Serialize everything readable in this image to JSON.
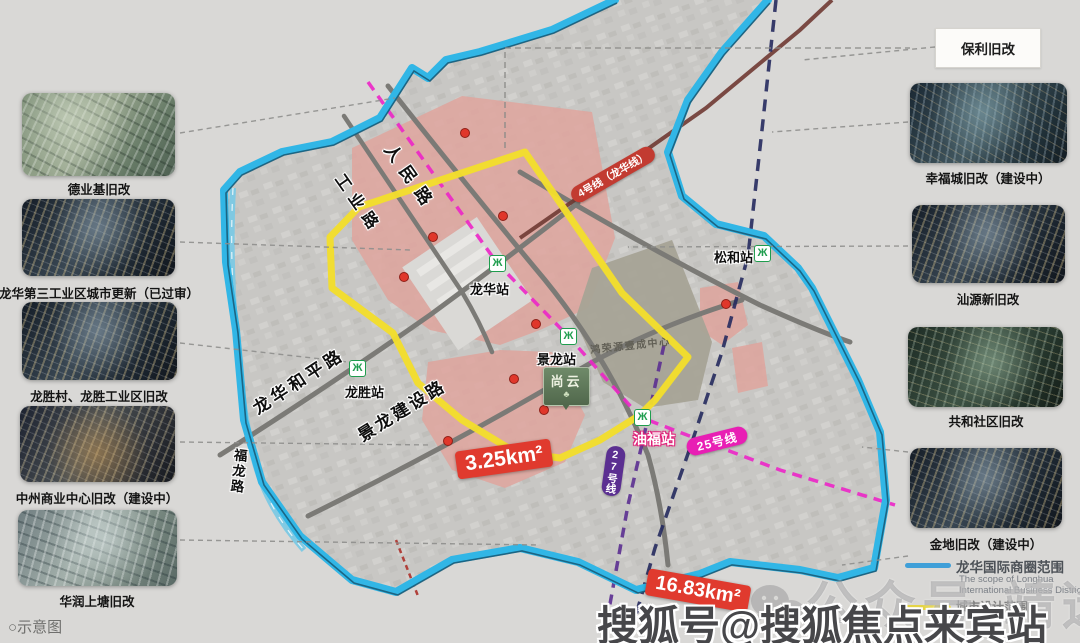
{
  "left_panel": {
    "items": [
      {
        "label": "德业基旧改"
      },
      {
        "label": "龙华第三工业区城市更新（已过审）"
      },
      {
        "label": "龙胜村、龙胜工业区旧改"
      },
      {
        "label": "中州商业中心旧改（建设中）"
      },
      {
        "label": "华润上塘旧改"
      }
    ]
  },
  "right_panel": {
    "callout": "保利旧改",
    "items": [
      {
        "label": "幸福城旧改（建设中）"
      },
      {
        "label": "汕源新旧改"
      },
      {
        "label": "共和社区旧改"
      },
      {
        "label": "金地旧改（建设中）"
      }
    ]
  },
  "map": {
    "metro_glyph": "Ж",
    "roads": {
      "renmin": "人民路",
      "gongye": "工业路",
      "longhuaheping": "龙华和平路",
      "jinglongjianshe": "景龙建设路",
      "fulong": "福龙路"
    },
    "stations": {
      "longhua": "龙华站",
      "jinglong": "景龙站",
      "longsheng": "龙胜站",
      "songhe": "松和站",
      "youfu": "油福站"
    },
    "lines": {
      "line4": "4号线（龙华线）",
      "line25": "25号线",
      "line27": "27号线"
    },
    "landmarks": {
      "yicheng": "鸿荣源壹成中心",
      "shangyun": "尚云",
      "shangyun_mark": "♣"
    },
    "areas": {
      "core": "3.25km²",
      "total": "16.83km²"
    }
  },
  "legend": {
    "scope_zh": "龙华国际商圈范围",
    "scope_en1": "The scope of Longhua",
    "scope_en2": "International Business District",
    "design_zh": "城市设计范围"
  },
  "footer": {
    "bullet": "○",
    "note": "示意图"
  },
  "watermark": {
    "faint": "公众号·靖选房产",
    "bold": "搜狐号@搜狐焦点来宾站"
  },
  "colors": {
    "boundary_blue": "#31b6e6",
    "core_yellow": "#f2de2c",
    "metro_green": "#1f9d4e",
    "line4_red": "#c23b31",
    "line25_pink": "#e81fb4",
    "line27_purple": "#5b2f91",
    "pink_area": "#dfa49d",
    "red_marker": "#d93025",
    "measure_red": "#e03a2e"
  }
}
